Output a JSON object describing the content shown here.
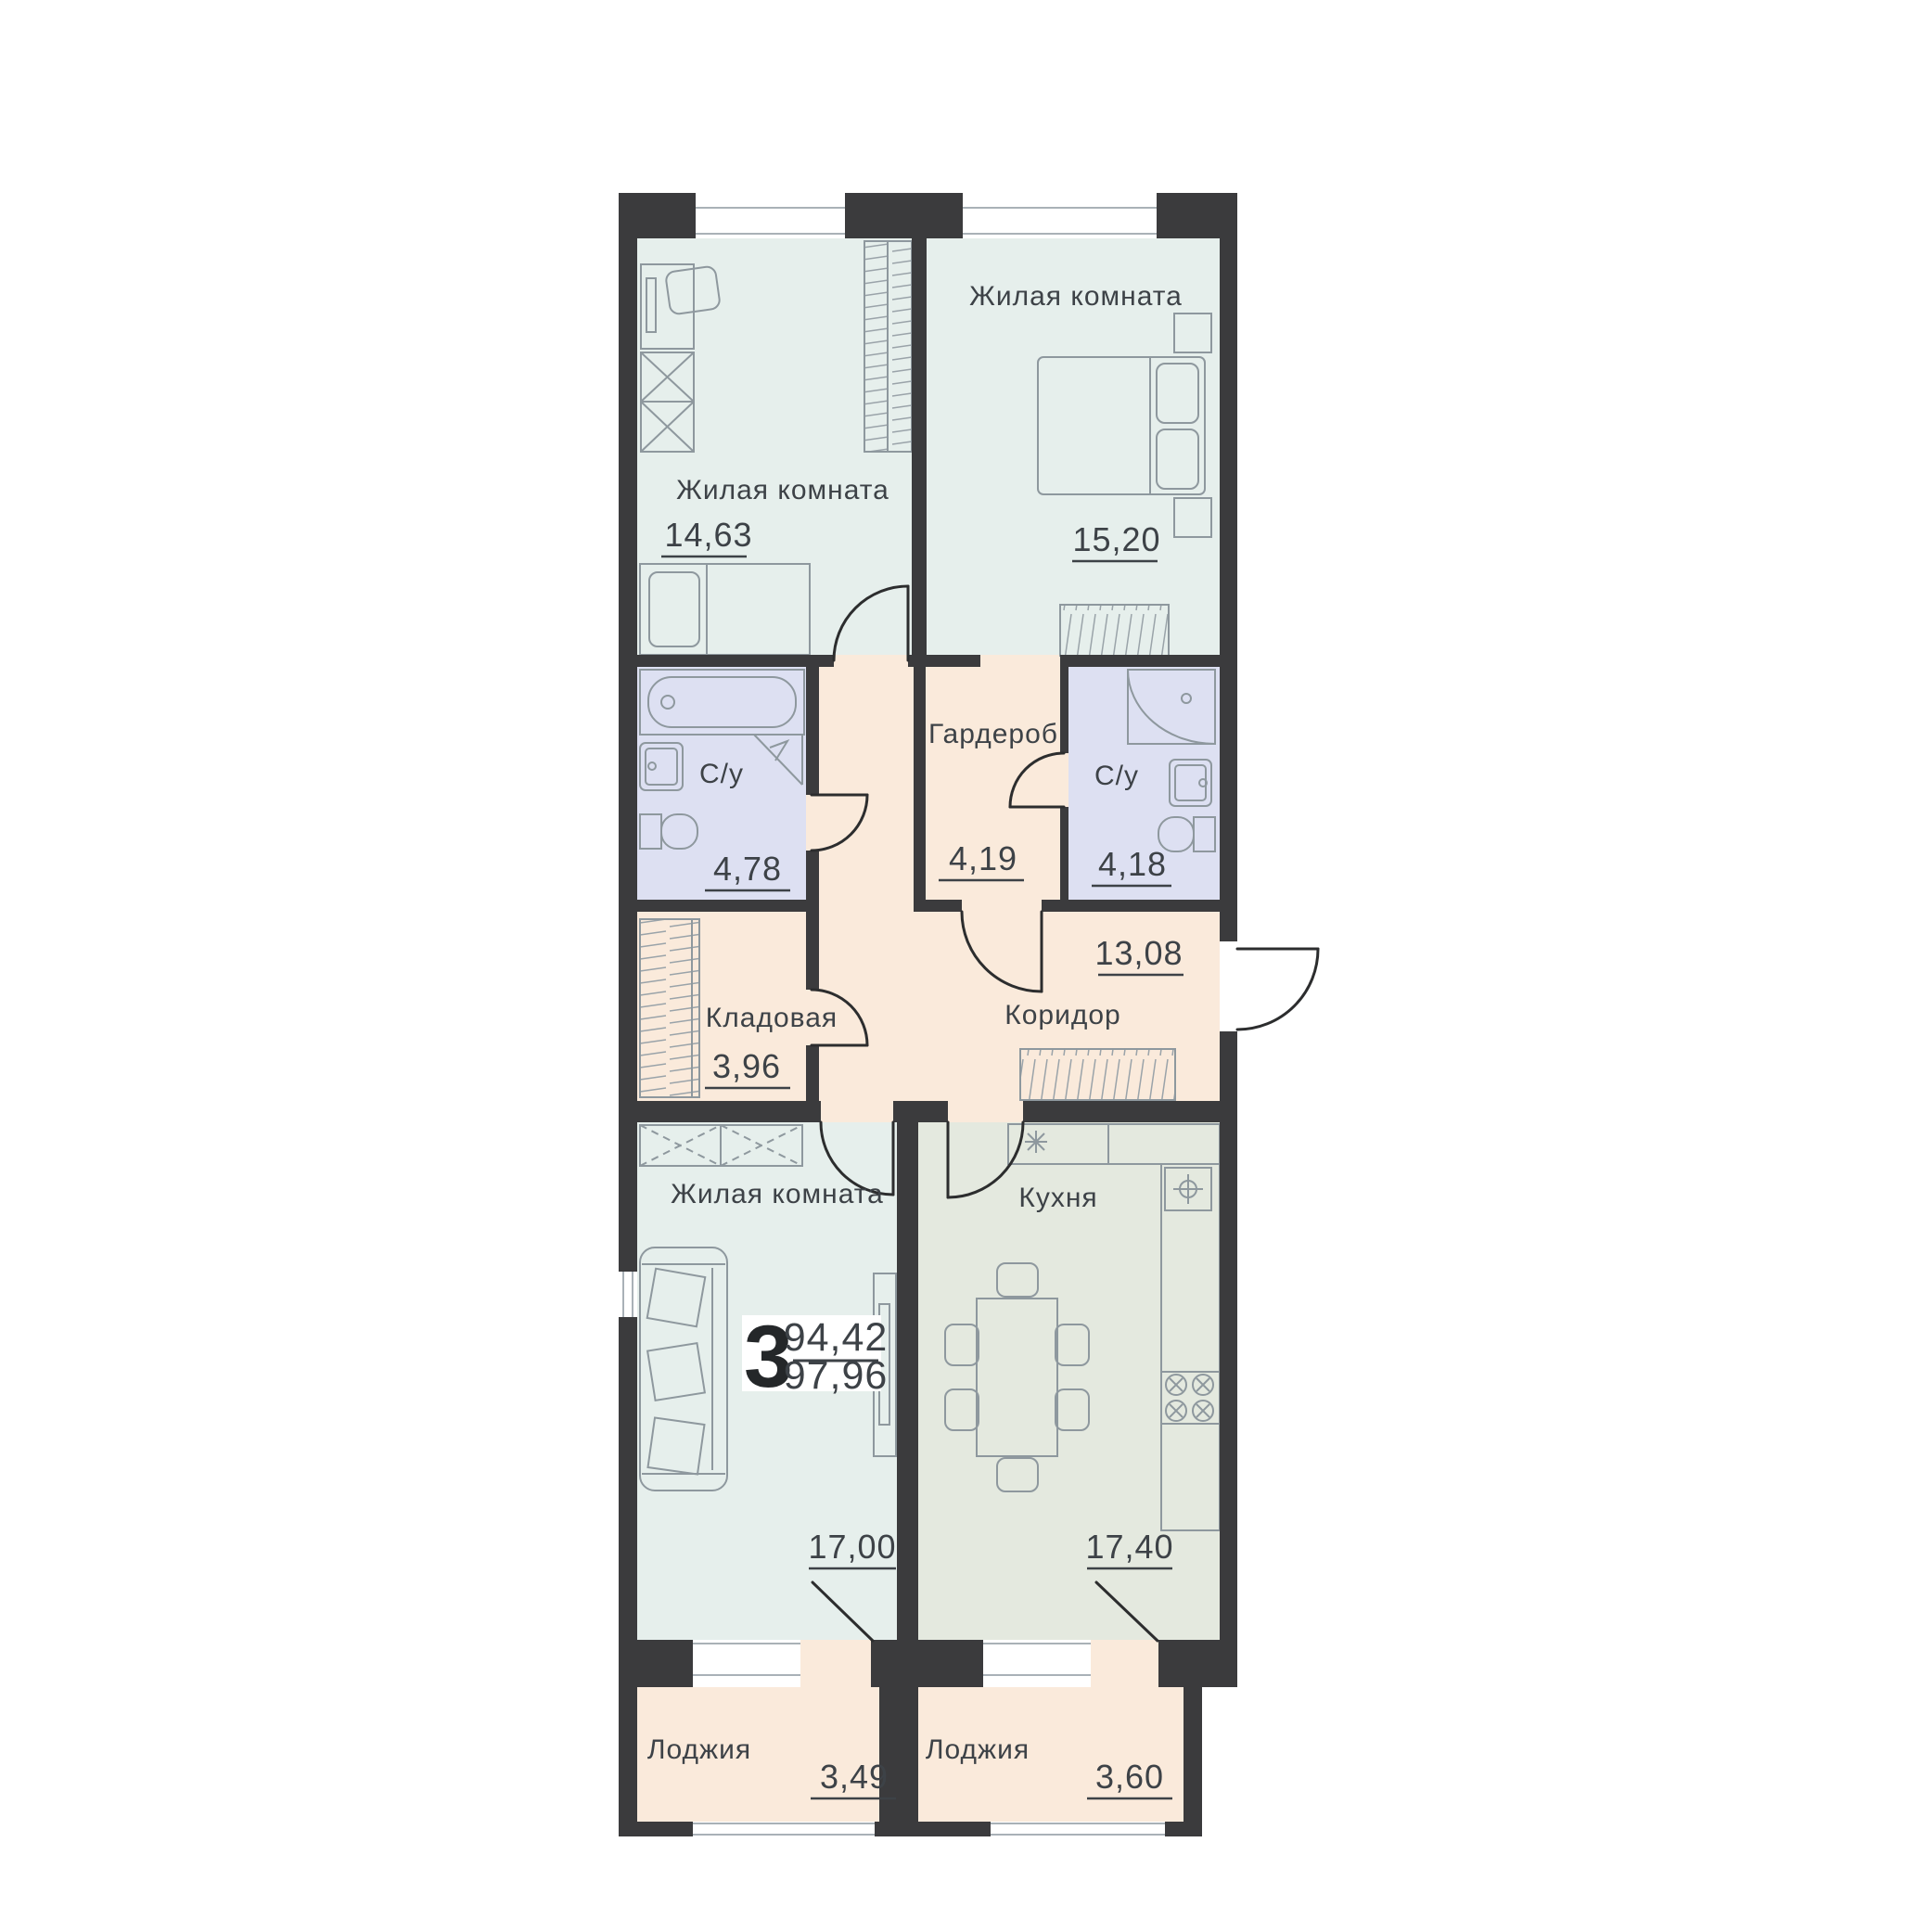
{
  "plan": {
    "kind": "apartment floor plan",
    "language": "ru"
  },
  "rooms": [
    {
      "id": "living1",
      "label": "Жилая комната",
      "area": "14,63"
    },
    {
      "id": "living2",
      "label": "Жилая комната",
      "area": "15,20"
    },
    {
      "id": "bath1",
      "label": "С/у",
      "area": "4,78"
    },
    {
      "id": "wardrobe",
      "label": "Гардероб",
      "area": "4,19"
    },
    {
      "id": "bath2",
      "label": "С/у",
      "area": "4,18"
    },
    {
      "id": "corridor",
      "label": "Коридор",
      "area": "13,08"
    },
    {
      "id": "storage",
      "label": "Кладовая",
      "area": "3,96"
    },
    {
      "id": "living3",
      "label": "Жилая комната",
      "area": "17,00"
    },
    {
      "id": "kitchen",
      "label": "Кухня",
      "area": "17,40"
    },
    {
      "id": "loggia1",
      "label": "Лоджия",
      "area": "3,49"
    },
    {
      "id": "loggia2",
      "label": "Лоджия",
      "area": "3,60"
    }
  ],
  "summary": {
    "room_count": "3",
    "area_upper": "94,42",
    "area_lower": "97,96"
  },
  "colors": {
    "wall": "#3b3b3d",
    "room_fill": "#e6efec",
    "kitchen_fill": "#e4e9df",
    "bathroom_fill": "#dde0f2",
    "hallway_fill": "#faeadb",
    "furniture_line": "#8e989e",
    "door_line": "#2c2d2e",
    "text": "#3d4247",
    "background": "#ffffff"
  }
}
